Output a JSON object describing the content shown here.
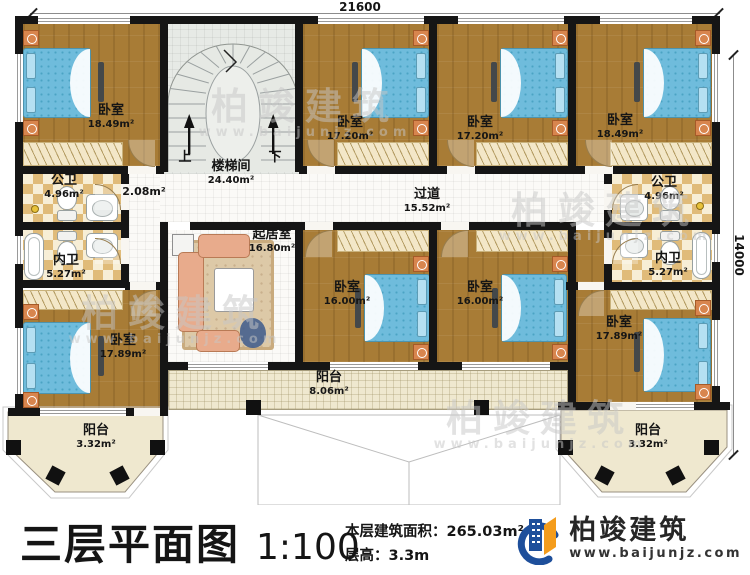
{
  "dimensions": {
    "top": "21600",
    "right": "14000"
  },
  "stairwell": {
    "up": "上",
    "down": "下"
  },
  "rooms": {
    "bedroom_tl": {
      "name": "卧室",
      "area": "18.49m²"
    },
    "stair": {
      "name": "楼梯间",
      "area": "24.40m²"
    },
    "bedroom_tml": {
      "name": "卧室",
      "area": "17.20m²"
    },
    "bedroom_tmr": {
      "name": "卧室",
      "area": "17.20m²"
    },
    "bedroom_tr": {
      "name": "卧室",
      "area": "18.49m²"
    },
    "bath_pub_left": {
      "name": "公卫",
      "area": "4.96m²"
    },
    "bath_pri_left": {
      "name": "内卫",
      "area": "5.27m²"
    },
    "hall_small": {
      "area": "2.08m²"
    },
    "corridor": {
      "name": "过道",
      "area": "15.52m²"
    },
    "bath_pub_right": {
      "name": "公卫",
      "area": "4.96m²"
    },
    "bath_pri_right": {
      "name": "内卫",
      "area": "5.27m²"
    },
    "living": {
      "name": "起居室",
      "area": "16.80m²"
    },
    "bedroom_bml": {
      "name": "卧室",
      "area": "16.00m²"
    },
    "bedroom_bmr": {
      "name": "卧室",
      "area": "16.00m²"
    },
    "bedroom_bl": {
      "name": "卧室",
      "area": "17.89m²"
    },
    "bedroom_br": {
      "name": "卧室",
      "area": "17.89m²"
    },
    "balcony_center": {
      "name": "阳台",
      "area": "8.06m²"
    },
    "balcony_left": {
      "name": "阳台",
      "area": "3.32m²"
    },
    "balcony_right": {
      "name": "阳台",
      "area": "3.32m²"
    }
  },
  "title": {
    "main": "三层平面图",
    "scale": "1:100",
    "area_label": "本层建筑面积：",
    "area_value": "265.03m²",
    "floor_height_label": "层高：",
    "floor_height_value": "3.3m"
  },
  "logo": {
    "company": "柏竣建筑",
    "website": "www.baijunjz.com"
  },
  "watermark": {
    "text": "柏竣建筑",
    "website": "www.baijunjz.com"
  },
  "colors": {
    "wall": "#151515",
    "wood": "#a87c36",
    "checker": "#e0bb79",
    "bed": "#6fbcdc",
    "brand_blue": "#1e4f9b",
    "brand_orange": "#f49c1c"
  }
}
